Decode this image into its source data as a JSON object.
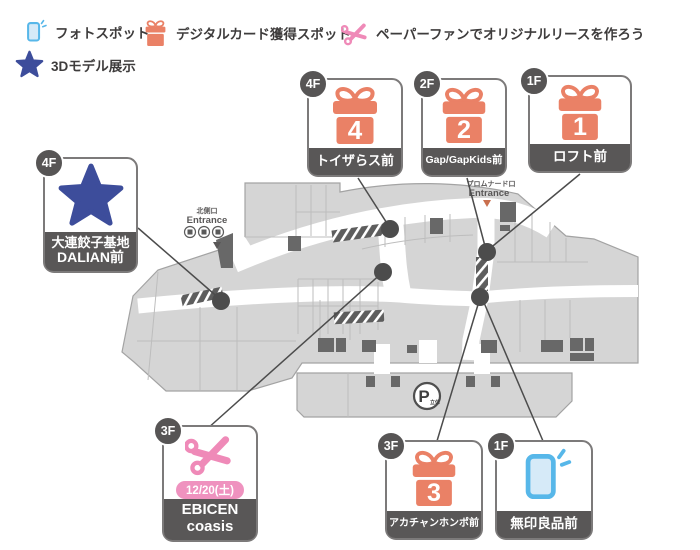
{
  "legend": {
    "items": [
      {
        "icon": "phone-icon",
        "label": "フォトスポット"
      },
      {
        "icon": "gift-icon",
        "label": "デジタルカード獲得スポット"
      },
      {
        "icon": "scissors-icon",
        "label": "ペーパーファンでオリジナルリースを作ろう"
      },
      {
        "icon": "star-icon",
        "label": "3Dモデル展示"
      }
    ]
  },
  "callouts": [
    {
      "id": "toysrus",
      "floor": "4F",
      "type": "gift",
      "number": "4",
      "label": "トイザらス前"
    },
    {
      "id": "gap-gapkids",
      "floor": "2F",
      "type": "gift",
      "number": "2",
      "label": "Gap/GapKids前"
    },
    {
      "id": "loft",
      "floor": "1F",
      "type": "gift",
      "number": "1",
      "label": "ロフト前"
    },
    {
      "id": "dalian",
      "floor": "4F",
      "type": "star",
      "label_line1": "大連餃子基地",
      "label_line2": "DALIAN前"
    },
    {
      "id": "ebicen",
      "floor": "3F",
      "type": "scissors",
      "date": "12/20(土)",
      "label_line1": "EBICEN",
      "label_line2": "coasis"
    },
    {
      "id": "akachanhonpo",
      "floor": "3F",
      "type": "gift",
      "number": "3",
      "label": "アカチャンホンポ前"
    },
    {
      "id": "muji",
      "floor": "1F",
      "type": "phone",
      "label": "無印良品前"
    }
  ],
  "map_labels": {
    "north_entrance_name": "北側口",
    "north_entrance_en": "Entrance",
    "promenade_entrance_name": "プロムナード口",
    "promenade_entrance_en": "Entrance",
    "parking": "P",
    "parking_note": "立体"
  },
  "colors": {
    "gift_orange": "#ea8166",
    "scissors_pink": "#ef8ab8",
    "phone_blue": "#57b7e9",
    "star_navy": "#3d4d9b",
    "label_dark": "#595757",
    "badge_dark": "#575555",
    "map_fill": "#d5d5d5",
    "map_stroke": "#a3a3a3",
    "date_pill": "#ef92bf"
  }
}
